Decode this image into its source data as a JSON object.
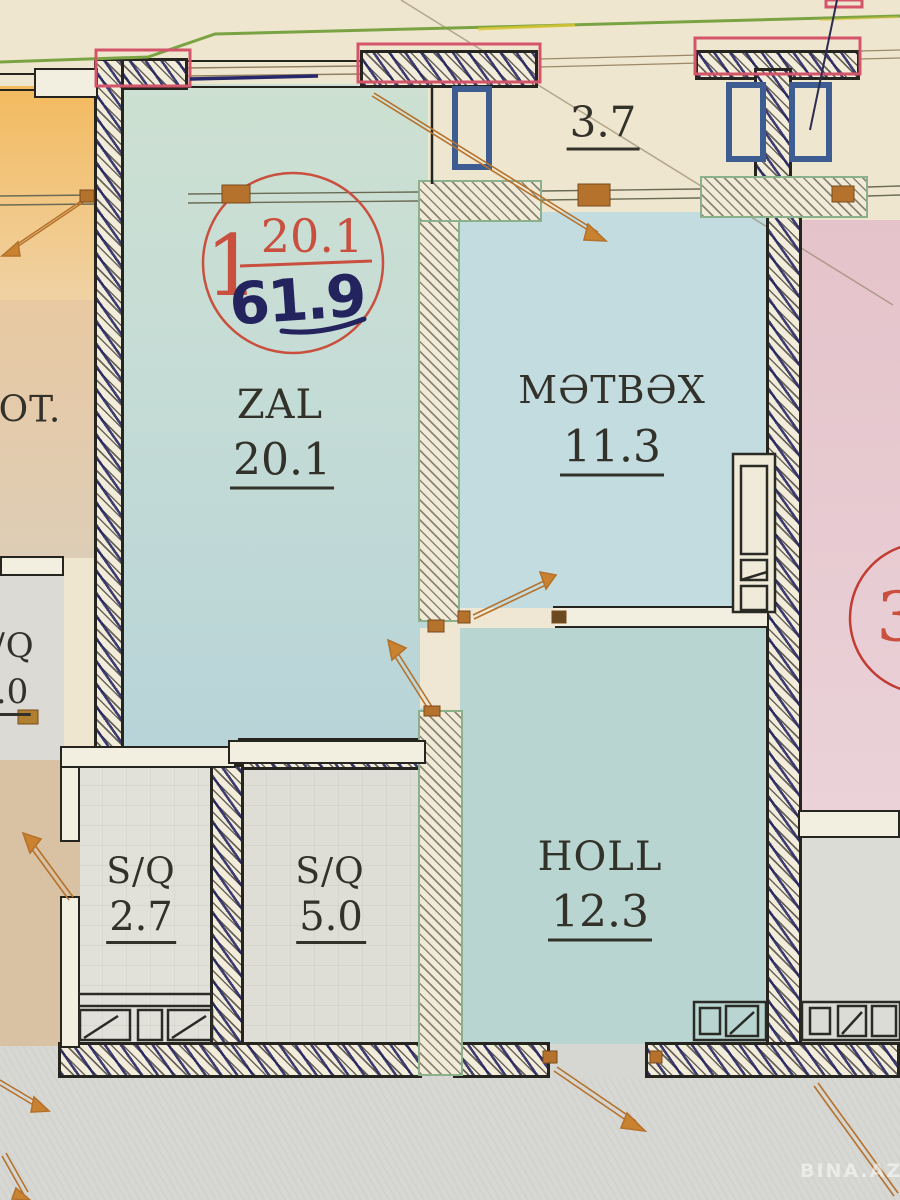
{
  "plan": {
    "unit_badge": {
      "number": "1",
      "printed_area": "20.1",
      "handwritten_area": "61.9"
    },
    "balcony_area": "3.7",
    "rooms": [
      {
        "name": "ZAL",
        "area": "20.1"
      },
      {
        "name": "MƏTBƏX",
        "area": "11.3"
      },
      {
        "name": "HOLL",
        "area": "12.3"
      },
      {
        "name": "S/Q",
        "area": "2.7"
      },
      {
        "name": "S/Q",
        "area": "5.0"
      }
    ],
    "adjacent": {
      "left_room": "OT.",
      "left_bath_name": "/Q",
      "left_bath_area": ".0",
      "right_unit_number": "3"
    },
    "watermark": "BINA.AZ",
    "colors": {
      "wall_ink": "#26241f",
      "pen_blue": "#23235e",
      "stamp_red": "#c94f3e",
      "door_orange": "#b5722c",
      "partition_green": "#8ab08c",
      "zal_fill": "#c0d8d6",
      "kitchen_fill": "#c3dce0",
      "holl_fill": "#b9d5d1",
      "pink_fill": "#e5c3cb"
    }
  }
}
